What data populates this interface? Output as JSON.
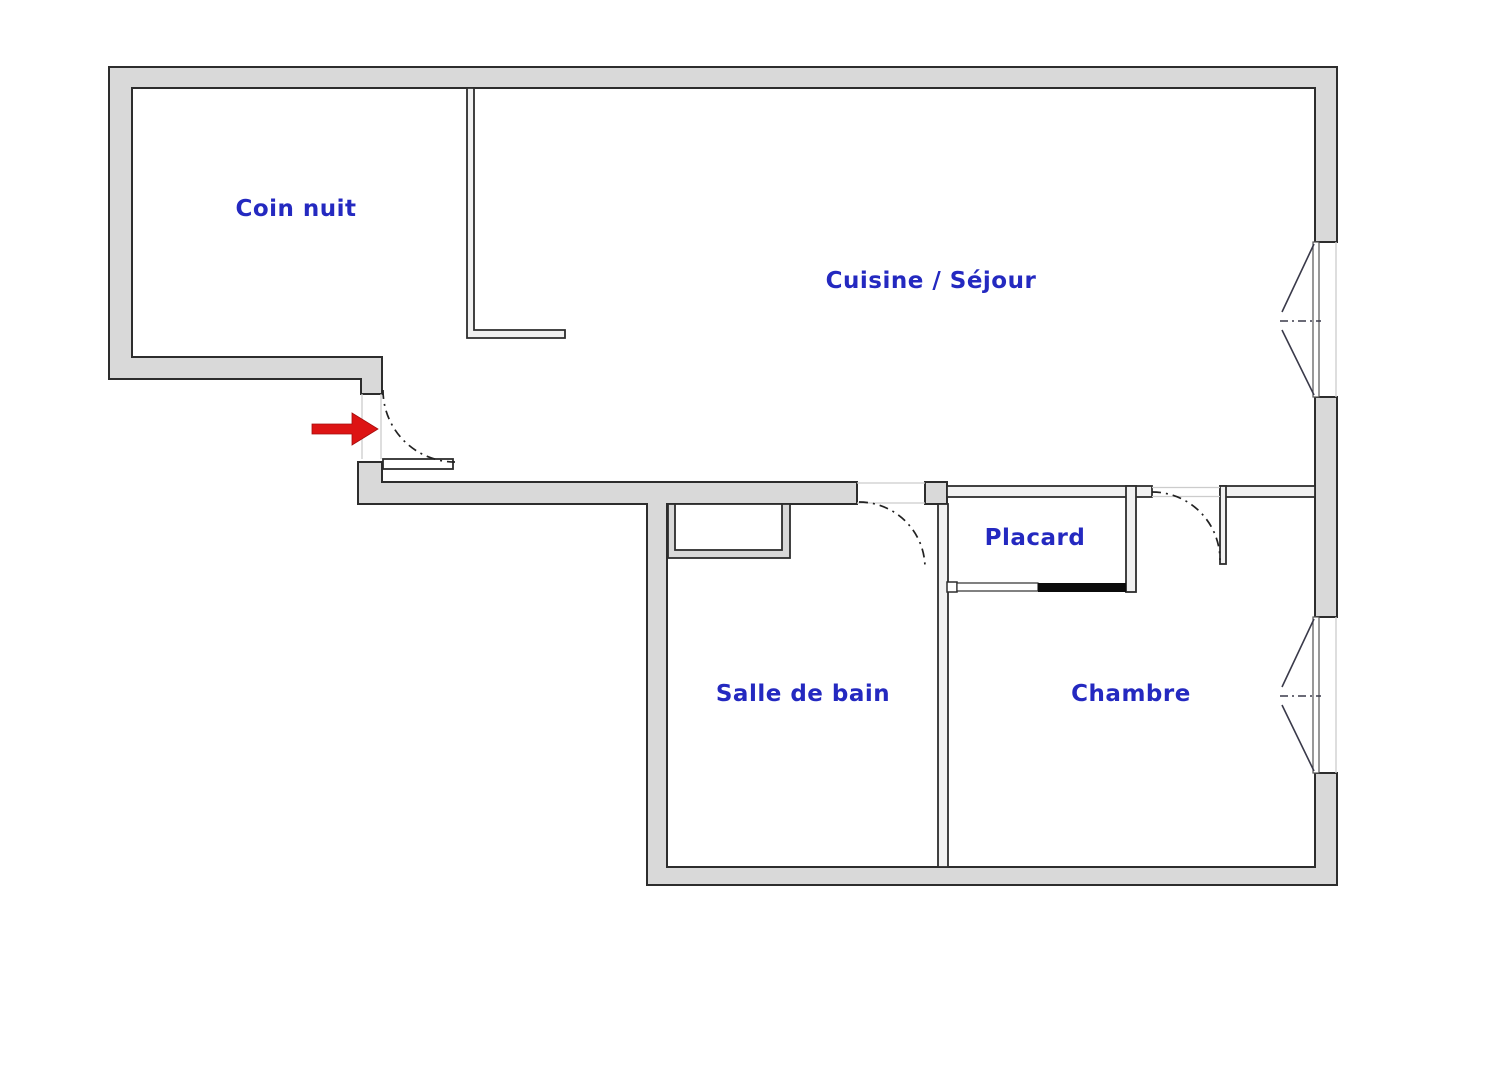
{
  "plan": {
    "title": "Plan d'appartement",
    "rooms": [
      {
        "id": "coin-nuit",
        "name": "Coin nuit"
      },
      {
        "id": "cuisine-sejour",
        "name": "Cuisine / Séjour"
      },
      {
        "id": "placard",
        "name": "Placard"
      },
      {
        "id": "salle-de-bain",
        "name": "Salle de bain"
      },
      {
        "id": "chambre",
        "name": "Chambre"
      }
    ],
    "entrance_marker_icon": "red-arrow",
    "features": {
      "doors": [
        "entrance-door",
        "bathroom-door",
        "bedroom-door"
      ],
      "windows": [
        "window-top-right",
        "window-bottom-right"
      ],
      "closet_panel": "sliding-panel"
    },
    "colors": {
      "wall_fill": "#d9d9d9",
      "wall_line": "#2d2d2d",
      "partition_fill": "#f1f1f1",
      "label_text": "#2429c0",
      "entrance_arrow": "#dd1414",
      "door_panel": "#0b0b0b"
    }
  }
}
